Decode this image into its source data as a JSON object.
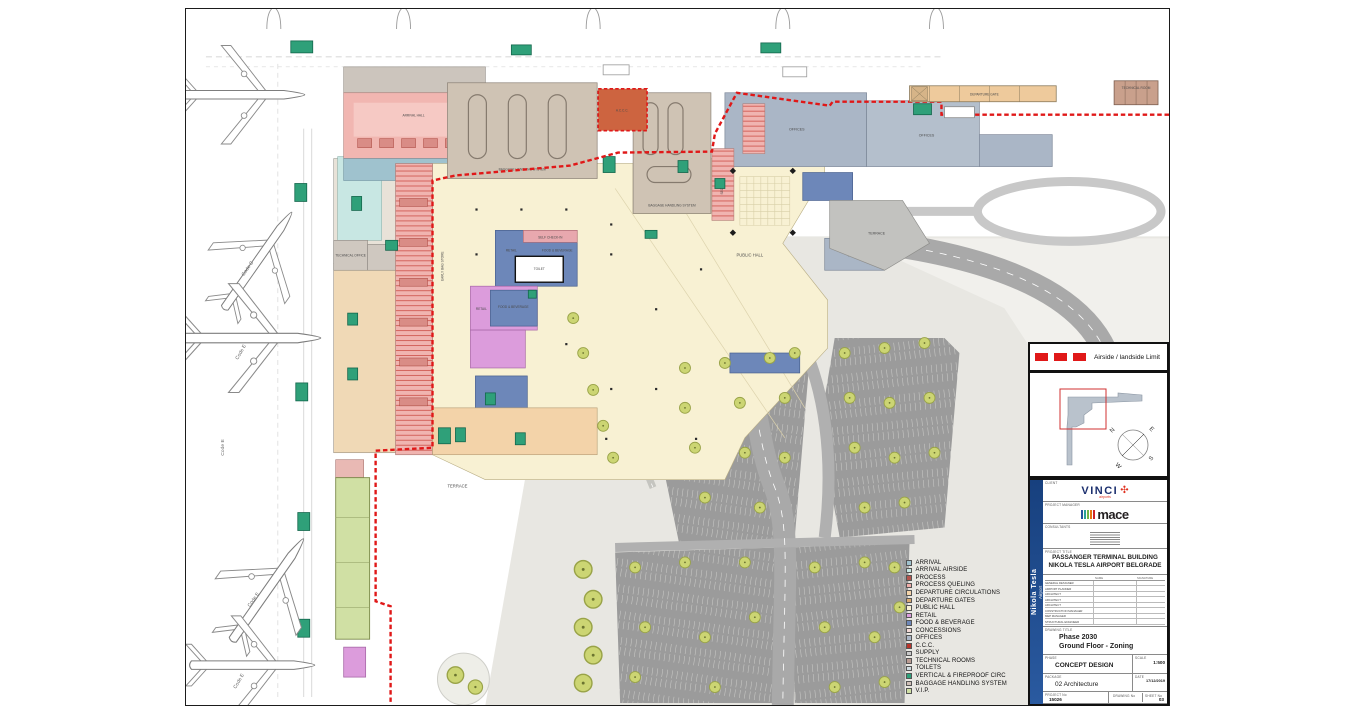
{
  "plan": {
    "labels": {
      "arrival_hall": "ARRIVAL HALL",
      "bhs": "BAGGAGE HANDLING SYSTEM",
      "offices": "OFFICES",
      "accc": "A.C.C.C.",
      "public_hall": "PUBLIC HALL",
      "terrace": "TERRACE",
      "retail": "RETAIL",
      "fnb": "FOOD & BEVERAGE",
      "self_checkin": "SELF CHECK-IN",
      "security": "SECURITY",
      "toilet": "TOILET",
      "departure_gate": "DEPARTURE GATE",
      "technical_room": "TECHNICAL ROOM",
      "technical_office": "TECHNICAL OFFICE",
      "early_bag": "EARLY BAG STORE",
      "code_c": "Code C",
      "code_e": "Code E"
    }
  },
  "airside_legend": {
    "label": "Airside / landside Limit",
    "color": "#e01818"
  },
  "compass": {
    "n": "N",
    "e": "E",
    "s": "S",
    "w": "W"
  },
  "zone_legend": {
    "items": [
      {
        "label": "ARRIVAL",
        "color": "#9fc2ce"
      },
      {
        "label": "ARRIVAL AIRSIDE",
        "color": "#c8e7e3"
      },
      {
        "label": "PROCESS",
        "color": "#b3534c"
      },
      {
        "label": "PROCESS QUELING",
        "color": "#efada9"
      },
      {
        "label": "DEPARTURE CIRCULATIONS",
        "color": "#f3d3a9"
      },
      {
        "label": "DEPARTURE GATES",
        "color": "#d9a96f"
      },
      {
        "label": "PUBLIC HALL",
        "color": "#f8f1d3"
      },
      {
        "label": "RETAIL",
        "color": "#dc9cdc"
      },
      {
        "label": "FOOD & BEVERAGE",
        "color": "#6d87b9"
      },
      {
        "label": "CONCESSIONS",
        "color": "#f3dad6"
      },
      {
        "label": "OFFICES",
        "color": "#aab6c6"
      },
      {
        "label": "C.C.C.",
        "color": "#b8352c"
      },
      {
        "label": "SUPPLY",
        "color": "#c9c9c9"
      },
      {
        "label": "TECHNICAL ROOMS",
        "color": "#bb9c93"
      },
      {
        "label": "TOILETS",
        "color": "#cfdbe0"
      },
      {
        "label": "VERTICAL & FIREPROOF CIRC",
        "color": "#2fa079"
      },
      {
        "label": "BAGGAGE HANDLING SYSTEM",
        "color": "#d0c0b8"
      },
      {
        "label": "V.I.P.",
        "color": "#d0e0a4"
      }
    ]
  },
  "title_block": {
    "side_title": "Nikola Tesla",
    "side_sub": "Airport",
    "client_label": "CLIENT",
    "vinci": "VINCI",
    "vinci_sub": "airports",
    "pm_label": "PROJECT MANAGER",
    "mace": "mace",
    "consultants_label": "CONSULTANTS",
    "project_title_label": "PROJECT TITLE",
    "project_title_1": "PASSANGER TERMINAL BUILDING",
    "project_title_2": "NIKOLA TESLA AIRPORT BELGRADE",
    "roles_header_name": "NAME",
    "roles_header_sign": "SIGNATURE",
    "roles": [
      "GENERAL DESIGNER",
      "AIRPORT PLANNER",
      "ARCHITECT",
      "ARCHITECT",
      "ARCHITECT",
      "CONSTRUCTION MANAGER",
      "MEP MANAGER",
      "STRUCTURAL ENGINEER"
    ],
    "drawing_title_label": "DRAWING TITLE",
    "drawing_title_1": "Phase 2030",
    "drawing_title_2": "Ground Floor - Zoning",
    "phase_label": "PHASE",
    "phase": "CONCEPT DESIGN",
    "scale_label": "SCALE",
    "scale": "1:500",
    "date_label": "DATE",
    "date": "17/12/2019",
    "package_label": "PACKAGE",
    "package": "02 Architecture",
    "rev_label": "REVISION",
    "rev": "03",
    "project_no_label": "PROJECT No",
    "project_no": "15026",
    "drawing_no_label": "DRAWING No",
    "sheet_no_label": "SHEET No"
  },
  "mace_bar_colors": [
    "#24549c",
    "#2aa198",
    "#71b548",
    "#e87511",
    "#cc2229"
  ]
}
